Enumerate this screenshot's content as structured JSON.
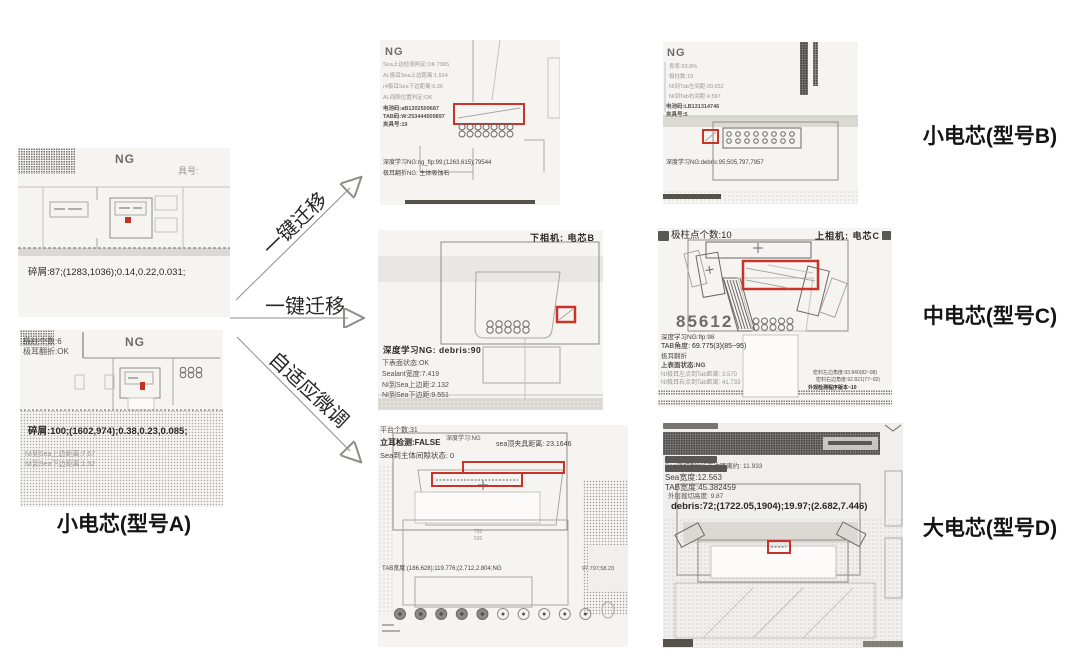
{
  "group_labels": {
    "a": "小电芯(型号A)",
    "b": "小电芯(型号B)",
    "c": "中电芯(型号C)",
    "d": "大电芯(型号D)"
  },
  "arrows": {
    "top": "一键迁移",
    "mid": "一键迁移",
    "bottom": "自适应微调"
  },
  "img_a1": {
    "ng": "NG",
    "tag": "具号:",
    "result": "碎屑:87;(1283,1036);0.14,0.22,0.031;"
  },
  "img_a2": {
    "ng": "NG",
    "info1": "极柱个数:6",
    "info2": "极耳翻折:OK",
    "result": "碎屑:100;(1602,974);0.38,0.23,0.085;",
    "sub1": "NI到Sea上边距离:7.67",
    "sub2": "NI到Sea下边距离:1.52"
  },
  "img_b1": {
    "ng": "NG",
    "info1": "Sea上边检测判定:OK 7965",
    "info2": "AL极耳Sea上边距离:1.914",
    "info3": "r4极耳Sea下边距离:6.36",
    "info4": "AL间隙位置判定:OK",
    "code1": "电池码:aB1302509687",
    "code2": "TAB码:W:253444509897",
    "code3": "夹具号:19",
    "result1": "深度学习NG:ng_flp:99;(1263,615);79544",
    "result2": "极耳翻折NG: 主体吸蚀右"
  },
  "img_b2": {
    "ng": "NG",
    "info1": "良率:93.8%",
    "info2": "极柱数:19",
    "info3": "NI到Tab左间距:20.652",
    "info4": "NI到Tab右间距:4.597",
    "code1": "电池码:LB131314746",
    "code2": "夹具号:5",
    "result1": "深度学习NG:debris:95;505,797,7957"
  },
  "img_c1": {
    "camera": "下相机: 电芯B",
    "result": "深度学习NG: debris:90",
    "line1": "下表面状态:OK",
    "line2": "Sealant宽度:7.419",
    "line3": "NI到Sea上边距:2.132",
    "line4": "NI到Sea下边距:9.551"
  },
  "img_c2": {
    "top": "极柱点个数:10",
    "camera": "上相机: 电芯C",
    "big_num": "85612",
    "line1": "深度学习NG:flp:98",
    "line2": "TAB角度: 69.775(3)(85~95)",
    "line3": "极耳翻折",
    "line4": "上表面状态:NG",
    "line5": "NI极耳左点到Tab距离: 3.570",
    "line6": "NI极耳右点到Tab距离: 41.733",
    "small1": "密封左边角度:93.840(82~98)",
    "small2": "密封右边角度:92.821(77~92)",
    "small3": "外观检测程序版本~10"
  },
  "img_d1": {
    "line1": "平台个数:31",
    "line2a": "立耳检测:FALSE",
    "line2b": "深度学习:NG",
    "line2c": "sea顶夹具距离: 23.1646",
    "line3": "Sea到主体间隙状态: 0",
    "num1": "752",
    "num2": "520",
    "mid1": "TAB宽度:(186,628);119.776;(2.712,2.804;NG",
    "mid2": "97.797;58.23"
  },
  "img_d2": {
    "line1": "Sea底切到965下边距离约: 11.933",
    "line2": "Sea宽度:12.563",
    "line3": "TAB宽度:45.382459",
    "line4": "外层裁切高度: 9.87",
    "result": "debris:72;(1722.05,1904);19.97;(2.682,7.446)"
  }
}
